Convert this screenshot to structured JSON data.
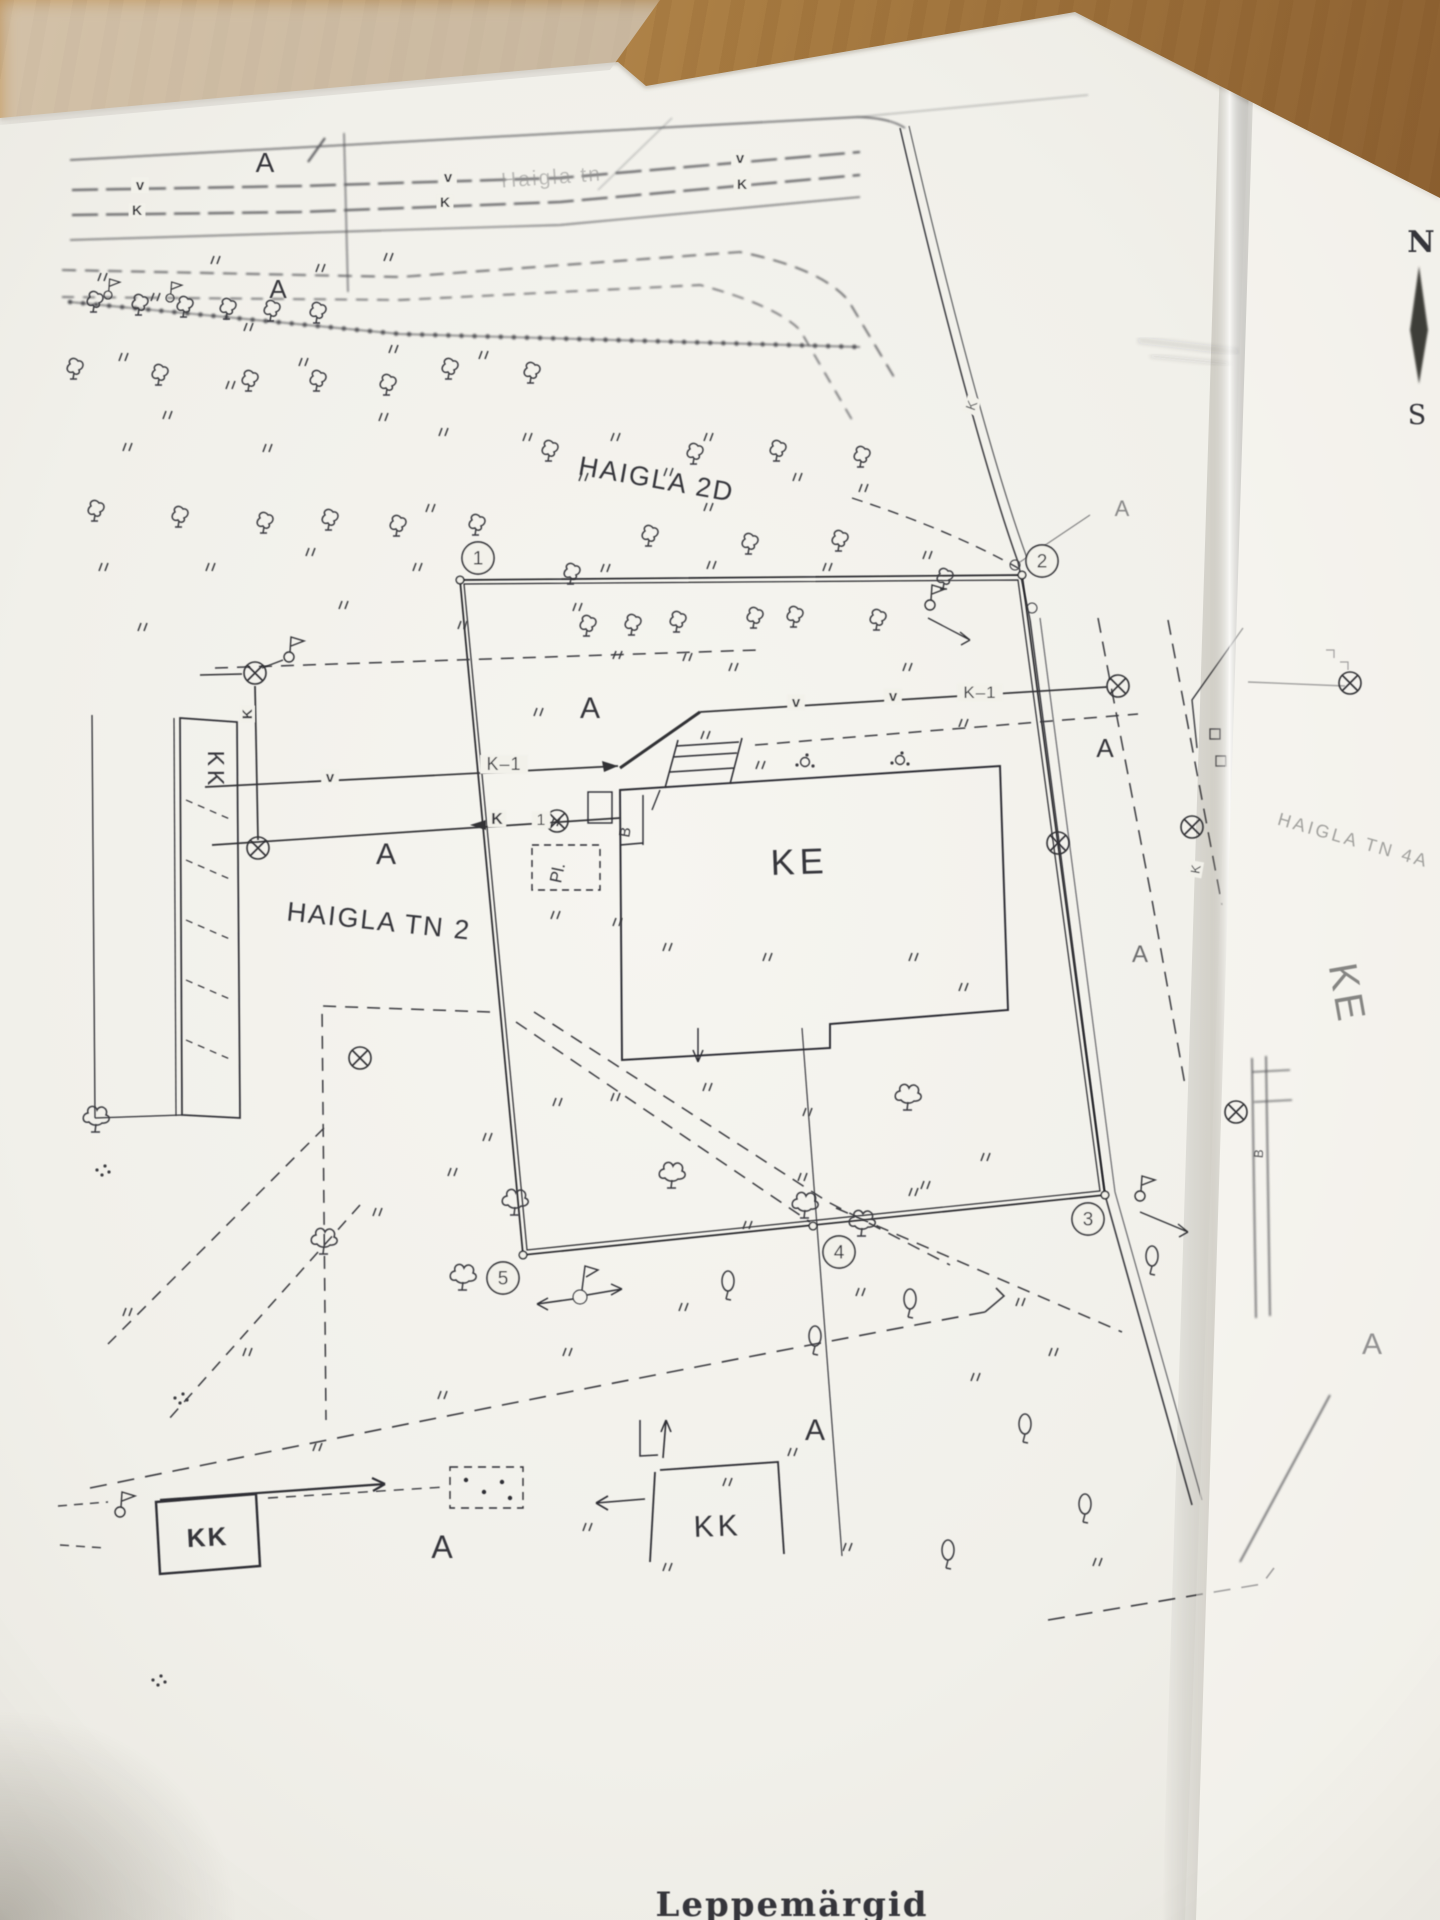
{
  "plan": {
    "colors": {
      "ink": "#34353a",
      "paper": "#f2f1ea",
      "faint": "#8d8d8a",
      "wood": "#a87c42"
    },
    "street": {
      "name": "Haigla tn"
    },
    "compass": {
      "north": "N",
      "south": "S"
    },
    "bottom_caption": "Leppemärgid",
    "labels": [
      {
        "t": "Haigla tn",
        "x": 552,
        "y": 184,
        "s": 21,
        "r": -4,
        "f": "#90908e",
        "o": 0.55,
        "sp": 2,
        "name": "street-name-label"
      },
      {
        "t": "HAIGLA 2D",
        "x": 655,
        "y": 488,
        "s": 27,
        "r": 10,
        "sp": 2,
        "name": "area-label-haigla-2d"
      },
      {
        "t": "HAIGLA TN 2",
        "x": 378,
        "y": 930,
        "s": 27,
        "r": 6,
        "sp": 2,
        "name": "area-label-haigla-tn-2"
      },
      {
        "t": "HAIGLA TN 4A",
        "x": 1352,
        "y": 846,
        "s": 18,
        "r": 16,
        "f": "#8d8d8a",
        "o": 0.8,
        "sp": 3,
        "name": "area-label-haigla-tn-4a"
      },
      {
        "t": "KE",
        "x": 800,
        "y": 874,
        "s": 36,
        "r": -2,
        "sp": 5,
        "name": "building-label-ke"
      },
      {
        "t": "KE",
        "x": 1334,
        "y": 996,
        "s": 40,
        "r": 80,
        "f": "#6a6a68",
        "o": 0.8,
        "sp": 4,
        "name": "building-label-ke-right"
      },
      {
        "t": "KK",
        "x": 208,
        "y": 770,
        "s": 23,
        "r": 90,
        "sp": 4,
        "name": "building-label-kk-left"
      },
      {
        "t": "KK",
        "x": 718,
        "y": 1536,
        "s": 30,
        "r": -2,
        "sp": 4,
        "name": "building-label-kk-bottom"
      },
      {
        "t": "KK",
        "x": 208,
        "y": 1546,
        "s": 26,
        "r": -3,
        "sp": 2,
        "w": 600,
        "name": "building-label-kk-bottom-left"
      },
      {
        "t": "N",
        "x": 1421,
        "y": 252,
        "s": 30,
        "serif": 1,
        "w": 600,
        "name": "compass-north-label"
      },
      {
        "t": "S",
        "x": 1417,
        "y": 424,
        "s": 27,
        "serif": 1,
        "name": "compass-south-label"
      },
      {
        "t": "A",
        "x": 265,
        "y": 172,
        "s": 28,
        "name": "surface-label-a"
      },
      {
        "t": "A",
        "x": 278,
        "y": 298,
        "s": 26,
        "name": "surface-label-a"
      },
      {
        "t": "A",
        "x": 386,
        "y": 864,
        "s": 30,
        "name": "surface-label-a"
      },
      {
        "t": "A",
        "x": 590,
        "y": 718,
        "s": 30,
        "name": "surface-label-a"
      },
      {
        "t": "A",
        "x": 1122,
        "y": 516,
        "s": 22,
        "o": 0.55,
        "name": "surface-label-a"
      },
      {
        "t": "A",
        "x": 1105,
        "y": 757,
        "s": 26,
        "name": "surface-label-a"
      },
      {
        "t": "A",
        "x": 1140,
        "y": 962,
        "s": 24,
        "o": 0.7,
        "name": "surface-label-a"
      },
      {
        "t": "A",
        "x": 815,
        "y": 1440,
        "s": 30,
        "name": "surface-label-a"
      },
      {
        "t": "A",
        "x": 442,
        "y": 1558,
        "s": 32,
        "name": "surface-label-a"
      },
      {
        "t": "A",
        "x": 1372,
        "y": 1354,
        "s": 30,
        "o": 0.5,
        "name": "surface-label-a"
      },
      {
        "t": "v",
        "x": 140,
        "y": 190,
        "s": 15,
        "w": 600,
        "bg": 1,
        "name": "water-line-marker"
      },
      {
        "t": "v",
        "x": 448,
        "y": 182,
        "s": 15,
        "w": 600,
        "bg": 1,
        "name": "water-line-marker"
      },
      {
        "t": "v",
        "x": 740,
        "y": 163,
        "s": 15,
        "w": 600,
        "bg": 1,
        "name": "water-line-marker"
      },
      {
        "t": "K",
        "x": 137,
        "y": 215,
        "s": 14,
        "w": 600,
        "bg": 1,
        "name": "sewer-line-marker"
      },
      {
        "t": "K",
        "x": 445,
        "y": 207,
        "s": 14,
        "w": 600,
        "bg": 1,
        "name": "sewer-line-marker"
      },
      {
        "t": "K",
        "x": 742,
        "y": 189,
        "s": 14,
        "w": 600,
        "bg": 1,
        "name": "sewer-line-marker"
      },
      {
        "t": "v",
        "x": 796,
        "y": 707,
        "s": 15,
        "w": 600,
        "bg": 1,
        "name": "water-line-marker"
      },
      {
        "t": "v",
        "x": 893,
        "y": 701,
        "s": 15,
        "w": 600,
        "bg": 1,
        "name": "water-line-marker"
      },
      {
        "t": "K–1",
        "x": 980,
        "y": 698,
        "s": 17,
        "sp": 1,
        "bg": 1,
        "name": "utility-label-k1"
      },
      {
        "t": "v",
        "x": 330,
        "y": 782,
        "s": 15,
        "w": 600,
        "bg": 1,
        "name": "water-line-marker"
      },
      {
        "t": "K–1",
        "x": 504,
        "y": 770,
        "s": 18,
        "sp": 1,
        "bg": 1,
        "name": "utility-label-k1"
      },
      {
        "t": "K",
        "x": 497,
        "y": 824,
        "s": 16,
        "w": 600,
        "bg": 1,
        "name": "sewer-line-marker"
      },
      {
        "t": "1",
        "x": 541,
        "y": 825,
        "s": 16,
        "bg": 1,
        "name": "utility-label-k1-digit"
      },
      {
        "t": "K",
        "x": 252,
        "y": 714,
        "s": 14,
        "r": -90,
        "w": 600,
        "bg": 1,
        "name": "sewer-line-marker"
      },
      {
        "t": "K",
        "x": 1200,
        "y": 870,
        "s": 13,
        "r": -80,
        "bg": 1,
        "name": "sewer-line-marker"
      },
      {
        "t": "K",
        "x": 976,
        "y": 407,
        "s": 14,
        "r": -70,
        "o": 0.8,
        "bg": 1,
        "name": "sewer-line-marker"
      },
      {
        "t": "B",
        "x": 630,
        "y": 833,
        "s": 15,
        "r": -80,
        "name": "entrance-label-b"
      },
      {
        "t": "Pl.",
        "x": 563,
        "y": 874,
        "s": 17,
        "r": -78,
        "name": "porch-label-pl"
      },
      {
        "t": "B",
        "x": 1263,
        "y": 1154,
        "s": 13,
        "r": -85,
        "o": 0.8,
        "name": "entrance-label-b"
      },
      {
        "t": "Leppemärgid",
        "x": 792,
        "y": 1916,
        "s": 34,
        "w": 700,
        "serif": 1,
        "sp": 2,
        "name": "sheet-caption-partial"
      }
    ],
    "corner_points": [
      {
        "n": "1",
        "x": 478,
        "y": 558
      },
      {
        "n": "2",
        "x": 1042,
        "y": 561
      },
      {
        "n": "3",
        "x": 1088,
        "y": 1219
      },
      {
        "n": "4",
        "x": 839,
        "y": 1252
      },
      {
        "n": "5",
        "x": 503,
        "y": 1278
      }
    ],
    "symbols": {
      "trees": [
        [
          95,
          303
        ],
        [
          140,
          306
        ],
        [
          185,
          308
        ],
        [
          228,
          310
        ],
        [
          272,
          312
        ],
        [
          318,
          314
        ],
        [
          75,
          370
        ],
        [
          160,
          376
        ],
        [
          250,
          382
        ],
        [
          318,
          382
        ],
        [
          388,
          386
        ],
        [
          450,
          370
        ],
        [
          532,
          374
        ],
        [
          96,
          512
        ],
        [
          180,
          518
        ],
        [
          265,
          524
        ],
        [
          330,
          521
        ],
        [
          398,
          527
        ],
        [
          477,
          526
        ],
        [
          550,
          452
        ],
        [
          695,
          455
        ],
        [
          778,
          452
        ],
        [
          862,
          458
        ],
        [
          572,
          575
        ],
        [
          650,
          537
        ],
        [
          750,
          545
        ],
        [
          840,
          542
        ],
        [
          945,
          580
        ],
        [
          588,
          627
        ],
        [
          633,
          626
        ],
        [
          678,
          623
        ],
        [
          755,
          619
        ],
        [
          795,
          618
        ],
        [
          878,
          621
        ]
      ],
      "bushy": [
        [
          672,
          1178
        ],
        [
          908,
          1100
        ],
        [
          515,
          1205
        ],
        [
          463,
          1280
        ],
        [
          805,
          1208
        ],
        [
          862,
          1226
        ],
        [
          324,
          1244
        ],
        [
          96,
          1122
        ]
      ],
      "ovals": [
        [
          728,
          1287
        ],
        [
          815,
          1342
        ],
        [
          910,
          1305
        ],
        [
          1152,
          1262
        ],
        [
          1025,
          1430
        ],
        [
          1085,
          1510
        ],
        [
          948,
          1556
        ]
      ],
      "dot_clusters": [
        [
          102,
          1170
        ],
        [
          180,
          1398
        ],
        [
          158,
          1680
        ]
      ],
      "bush_dots": [
        [
          805,
          762
        ],
        [
          900,
          760
        ]
      ],
      "manholes": [
        [
          255,
          673
        ],
        [
          258,
          848
        ],
        [
          360,
          1058
        ],
        [
          557,
          821
        ],
        [
          1118,
          686
        ],
        [
          1058,
          843
        ],
        [
          1192,
          827
        ],
        [
          1236,
          1112
        ],
        [
          1350,
          683
        ]
      ],
      "flags": [
        [
          289,
          657
        ],
        [
          930,
          605
        ],
        [
          1140,
          1196
        ],
        [
          120,
          1512
        ],
        [
          108,
          295,
          0.8
        ],
        [
          170,
          298,
          0.8
        ]
      ],
      "vertices": [
        [
          460,
          580
        ],
        [
          1022,
          575
        ],
        [
          1105,
          1195
        ],
        [
          523,
          1255
        ],
        [
          813,
          1226
        ]
      ],
      "grass": [
        [
          210,
          255
        ],
        [
          383,
          252
        ],
        [
          97,
          272
        ],
        [
          150,
          292
        ],
        [
          315,
          263
        ],
        [
          243,
          322
        ],
        [
          118,
          352
        ],
        [
          298,
          357
        ],
        [
          388,
          344
        ],
        [
          478,
          350
        ],
        [
          225,
          380
        ],
        [
          378,
          412
        ],
        [
          162,
          410
        ],
        [
          122,
          442
        ],
        [
          262,
          443
        ],
        [
          438,
          427
        ],
        [
          522,
          432
        ],
        [
          610,
          432
        ],
        [
          703,
          432
        ],
        [
          578,
          472
        ],
        [
          663,
          467
        ],
        [
          792,
          472
        ],
        [
          858,
          483
        ],
        [
          703,
          502
        ],
        [
          425,
          503
        ],
        [
          98,
          562
        ],
        [
          205,
          562
        ],
        [
          305,
          547
        ],
        [
          338,
          600
        ],
        [
          412,
          562
        ],
        [
          137,
          622
        ],
        [
          600,
          563
        ],
        [
          706,
          560
        ],
        [
          822,
          562
        ],
        [
          922,
          550
        ],
        [
          457,
          620
        ],
        [
          572,
          602
        ],
        [
          612,
          650
        ],
        [
          682,
          652
        ],
        [
          728,
          662
        ],
        [
          902,
          662
        ],
        [
          958,
          718
        ],
        [
          700,
          730
        ],
        [
          755,
          760
        ],
        [
          533,
          707
        ],
        [
          482,
          762
        ],
        [
          550,
          817
        ],
        [
          612,
          917
        ],
        [
          550,
          910
        ],
        [
          662,
          942
        ],
        [
          762,
          952
        ],
        [
          908,
          952
        ],
        [
          958,
          982
        ],
        [
          702,
          1082
        ],
        [
          610,
          1092
        ],
        [
          802,
          1107
        ],
        [
          908,
          1187
        ],
        [
          980,
          1152
        ],
        [
          552,
          1097
        ],
        [
          482,
          1132
        ],
        [
          447,
          1167
        ],
        [
          372,
          1207
        ],
        [
          242,
          1347
        ],
        [
          122,
          1307
        ],
        [
          312,
          1442
        ],
        [
          437,
          1390
        ],
        [
          562,
          1347
        ],
        [
          678,
          1302
        ],
        [
          742,
          1220
        ],
        [
          797,
          1172
        ],
        [
          920,
          1180
        ],
        [
          1015,
          1297
        ],
        [
          855,
          1287
        ],
        [
          970,
          1372
        ],
        [
          1048,
          1347
        ],
        [
          722,
          1477
        ],
        [
          787,
          1447
        ],
        [
          842,
          1542
        ],
        [
          1092,
          1557
        ],
        [
          662,
          1562
        ],
        [
          582,
          1522
        ]
      ]
    }
  }
}
